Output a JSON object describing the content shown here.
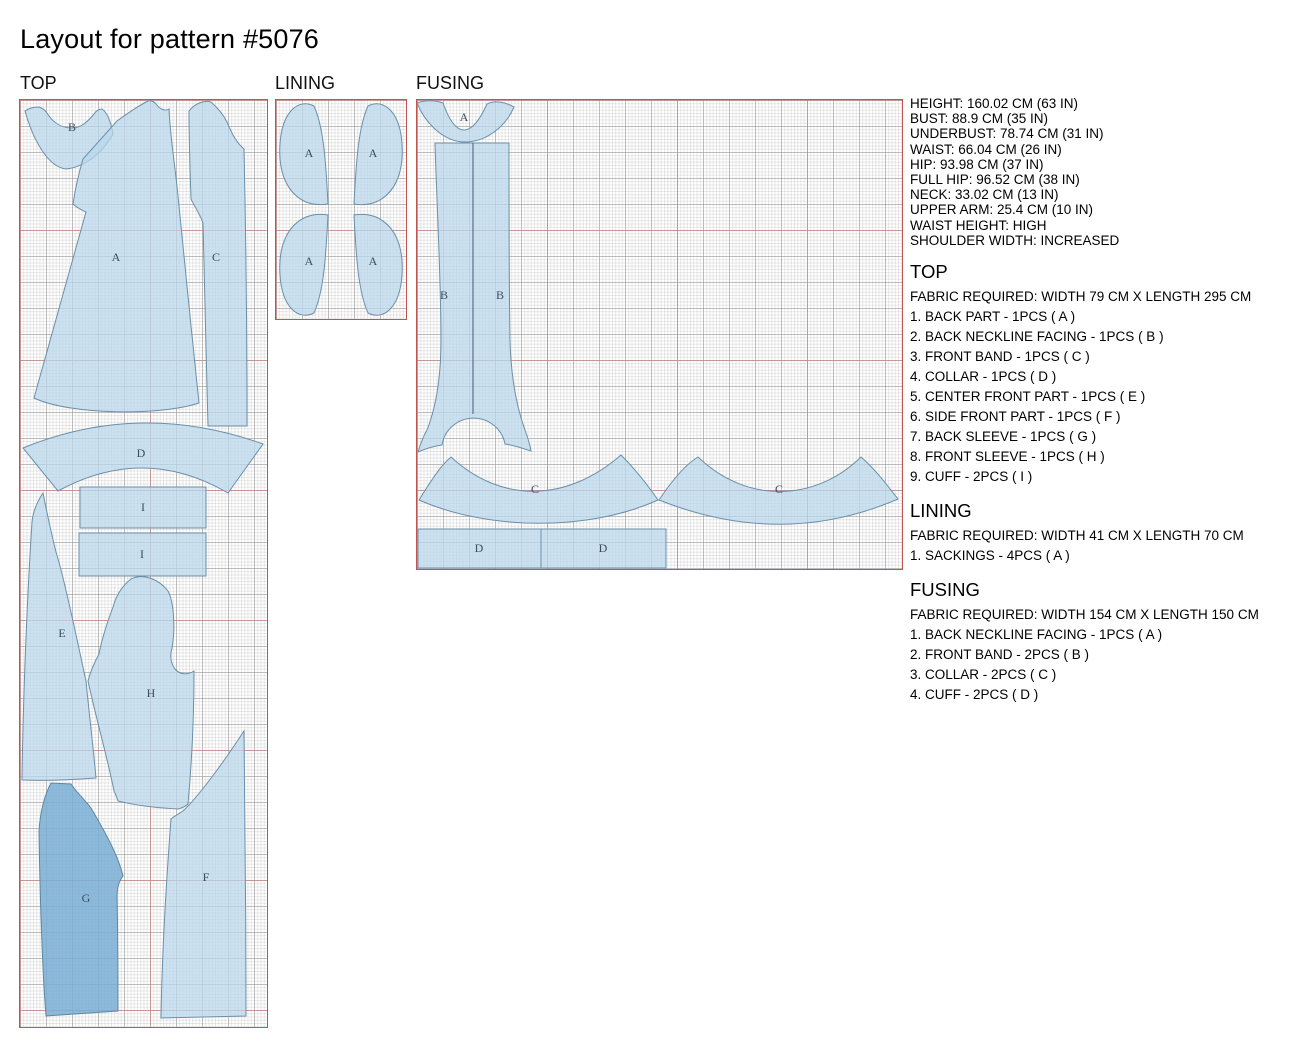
{
  "title": "Layout for pattern #5076",
  "panel_labels": {
    "top": "TOP",
    "lining": "LINING",
    "fusing": "FUSING"
  },
  "pieces": {
    "top": [
      "B",
      "A",
      "C",
      "D",
      "I",
      "I",
      "E",
      "H",
      "G",
      "F"
    ],
    "lining": [
      "A",
      "A",
      "A",
      "A"
    ],
    "fusing": [
      "A",
      "B",
      "B",
      "C",
      "C",
      "D",
      "D"
    ]
  },
  "measurements": [
    "HEIGHT: 160.02 CM (63 IN)",
    "BUST: 88.9 CM (35 IN)",
    "UNDERBUST: 78.74 CM (31 IN)",
    "WAIST: 66.04 CM (26 IN)",
    "HIP: 93.98 CM (37 IN)",
    "FULL HIP: 96.52 CM (38 IN)",
    "NECK: 33.02 CM (13 IN)",
    "UPPER ARM: 25.4 CM (10 IN)",
    "WAIST HEIGHT: HIGH",
    "SHOULDER WIDTH: INCREASED"
  ],
  "sections": {
    "top": {
      "heading": "TOP",
      "fabric": "FABRIC REQUIRED: WIDTH 79 CM X LENGTH 295 CM",
      "items": [
        "1. BACK PART - 1PCS ( A )",
        "2. BACK NECKLINE FACING - 1PCS ( B )",
        "3. FRONT BAND - 1PCS ( C )",
        "4. COLLAR - 1PCS ( D )",
        "5. CENTER FRONT PART - 1PCS ( E )",
        "6. SIDE FRONT PART - 1PCS ( F )",
        "7. BACK SLEEVE - 1PCS ( G )",
        "8. FRONT SLEEVE - 1PCS ( H )",
        "9. CUFF - 2PCS ( I )"
      ]
    },
    "lining": {
      "heading": "LINING",
      "fabric": "FABRIC REQUIRED: WIDTH 41 CM X LENGTH 70 CM",
      "items": [
        "1. SACKINGS - 4PCS ( A )"
      ]
    },
    "fusing": {
      "heading": "FUSING",
      "fabric": "FABRIC REQUIRED: WIDTH 154 CM X LENGTH 150 CM",
      "items": [
        "1. BACK NECKLINE FACING - 1PCS ( A )",
        "2. FRONT BAND - 2PCS ( B )",
        "3. COLLAR - 2PCS ( C )",
        "4. CUFF - 2PCS ( D )"
      ]
    }
  },
  "colors": {
    "panel_border": "#c0544e",
    "piece_fill": "#b9d7eb",
    "piece_fill_dark": "#79aed3",
    "piece_stroke": "#6b8fa9",
    "label_text": "#3c4c60"
  }
}
